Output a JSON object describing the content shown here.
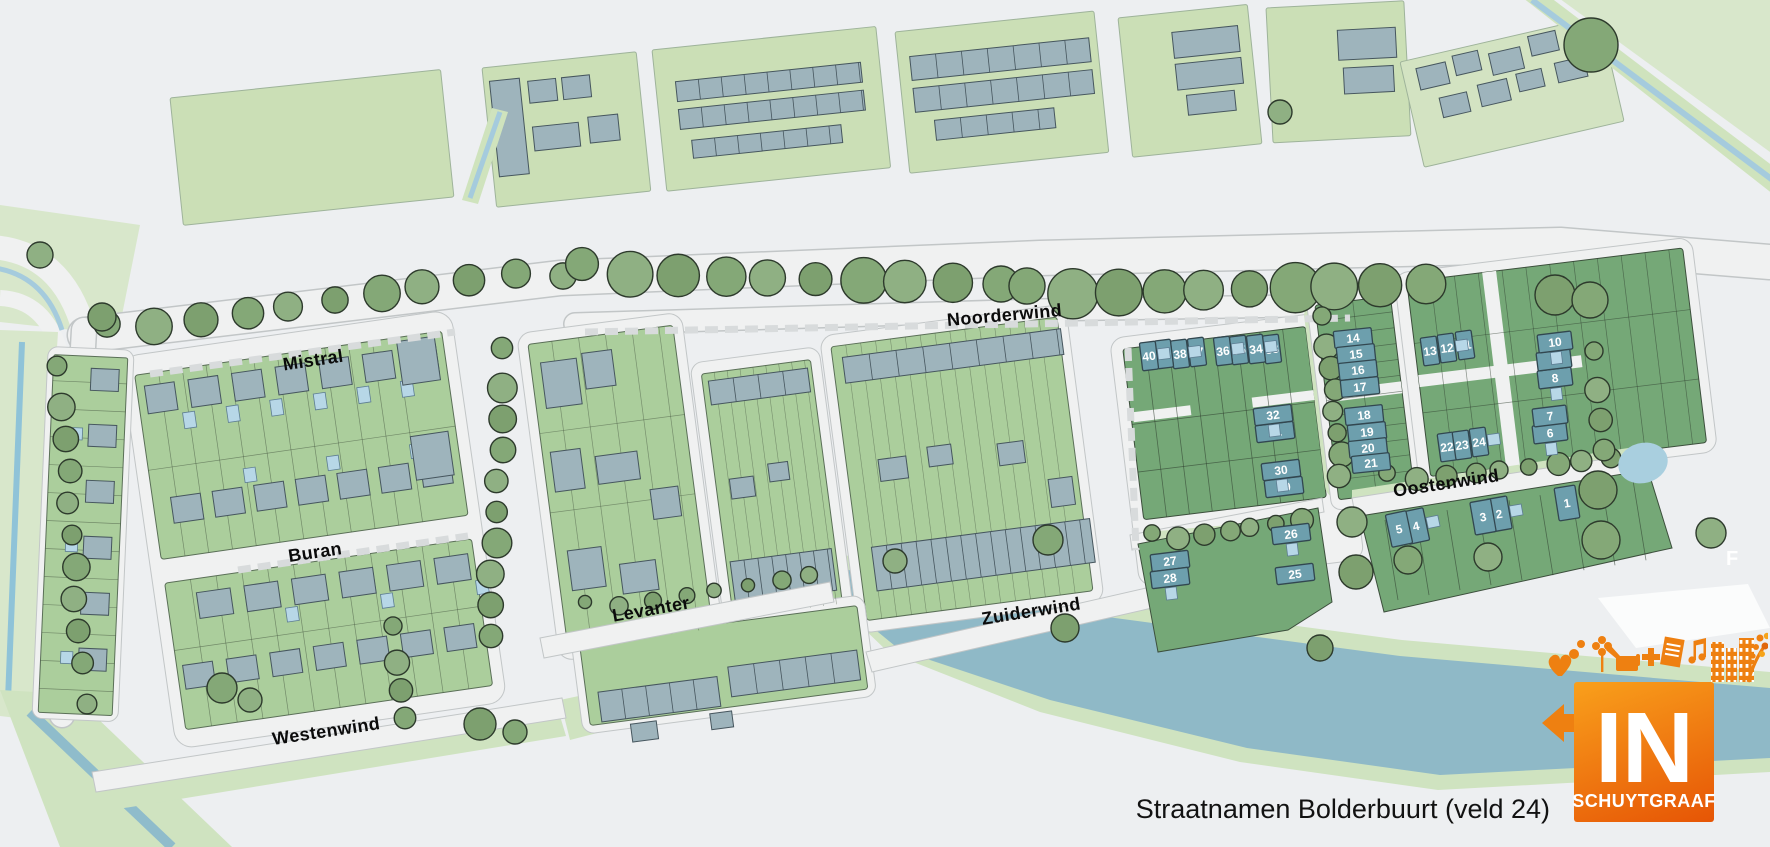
{
  "map": {
    "caption": "Straatnamen Bolderbuurt (veld 24)",
    "edge_label": "F",
    "streets": [
      {
        "name": "Mistral",
        "x": 314,
        "y": 366,
        "angle": -8.5
      },
      {
        "name": "Buran",
        "x": 316,
        "y": 558,
        "angle": -8.5
      },
      {
        "name": "Westenwind",
        "x": 327,
        "y": 737,
        "angle": -8.5
      },
      {
        "name": "Levanter",
        "x": 652,
        "y": 615,
        "angle": -10
      },
      {
        "name": "Noorderwind",
        "x": 1005,
        "y": 321,
        "angle": -5
      },
      {
        "name": "Zuiderwind",
        "x": 1032,
        "y": 617,
        "angle": -9
      },
      {
        "name": "Oostenwind",
        "x": 1447,
        "y": 489,
        "angle": -8.5
      }
    ],
    "lots": [
      {
        "n": 1,
        "x": 1567,
        "y": 503,
        "o": "V",
        "a": -9
      },
      {
        "n": 2,
        "x": 1499,
        "y": 514,
        "o": "V",
        "a": -10
      },
      {
        "n": 3,
        "x": 1483,
        "y": 517,
        "o": "V",
        "a": -10
      },
      {
        "n": 4,
        "x": 1416,
        "y": 526,
        "o": "V",
        "a": -12
      },
      {
        "n": 5,
        "x": 1399,
        "y": 529,
        "o": "V",
        "a": -12
      },
      {
        "n": 6,
        "x": 1550,
        "y": 433,
        "o": "H",
        "a": -7
      },
      {
        "n": 7,
        "x": 1550,
        "y": 416,
        "o": "H",
        "a": -7
      },
      {
        "n": 8,
        "x": 1555,
        "y": 378,
        "o": "H",
        "a": -7
      },
      {
        "n": 9,
        "x": 1554,
        "y": 360,
        "o": "H",
        "a": -7
      },
      {
        "n": 10,
        "x": 1555,
        "y": 342,
        "o": "H",
        "a": -7
      },
      {
        "n": 11,
        "x": 1465,
        "y": 345,
        "o": "v",
        "a": -8
      },
      {
        "n": 12,
        "x": 1447,
        "y": 348,
        "o": "v",
        "a": -8
      },
      {
        "n": 13,
        "x": 1430,
        "y": 351,
        "o": "v",
        "a": -8
      },
      {
        "n": 14,
        "x": 1353,
        "y": 338,
        "o": "h",
        "a": -6
      },
      {
        "n": 15,
        "x": 1356,
        "y": 354,
        "o": "h",
        "a": -6
      },
      {
        "n": 16,
        "x": 1358,
        "y": 370,
        "o": "h",
        "a": -6
      },
      {
        "n": 17,
        "x": 1360,
        "y": 387,
        "o": "h",
        "a": -6
      },
      {
        "n": 18,
        "x": 1364,
        "y": 415,
        "o": "h",
        "a": -6
      },
      {
        "n": 19,
        "x": 1367,
        "y": 432,
        "o": "h",
        "a": -6
      },
      {
        "n": 20,
        "x": 1368,
        "y": 448,
        "o": "h",
        "a": -6
      },
      {
        "n": 21,
        "x": 1371,
        "y": 463,
        "o": "h",
        "a": -6
      },
      {
        "n": 22,
        "x": 1447,
        "y": 447,
        "o": "v",
        "a": -8
      },
      {
        "n": 23,
        "x": 1462,
        "y": 445,
        "o": "v",
        "a": -8
      },
      {
        "n": 24,
        "x": 1479,
        "y": 442,
        "o": "v",
        "a": -8
      },
      {
        "n": 25,
        "x": 1295,
        "y": 574,
        "o": "h",
        "a": -7
      },
      {
        "n": 26,
        "x": 1291,
        "y": 534,
        "o": "h",
        "a": -7
      },
      {
        "n": 27,
        "x": 1170,
        "y": 561,
        "o": "h",
        "a": -7
      },
      {
        "n": 28,
        "x": 1170,
        "y": 578,
        "o": "h",
        "a": -7
      },
      {
        "n": 29,
        "x": 1284,
        "y": 487,
        "o": "h",
        "a": -7
      },
      {
        "n": 30,
        "x": 1281,
        "y": 470,
        "o": "h",
        "a": -7
      },
      {
        "n": 31,
        "x": 1275,
        "y": 432,
        "o": "h",
        "a": -7
      },
      {
        "n": 32,
        "x": 1273,
        "y": 415,
        "o": "h",
        "a": -7
      },
      {
        "n": 33,
        "x": 1272,
        "y": 349,
        "o": "v",
        "a": -7
      },
      {
        "n": 34,
        "x": 1256,
        "y": 349,
        "o": "v",
        "a": -7
      },
      {
        "n": 35,
        "x": 1239,
        "y": 350,
        "o": "v",
        "a": -7
      },
      {
        "n": 36,
        "x": 1223,
        "y": 351,
        "o": "v",
        "a": -7
      },
      {
        "n": 37,
        "x": 1197,
        "y": 352,
        "o": "v",
        "a": -7
      },
      {
        "n": 38,
        "x": 1180,
        "y": 354,
        "o": "v",
        "a": -7
      },
      {
        "n": 39,
        "x": 1164,
        "y": 354,
        "o": "v",
        "a": -7
      },
      {
        "n": 40,
        "x": 1149,
        "y": 356,
        "o": "v",
        "a": -7
      }
    ]
  },
  "logo": {
    "word": "IN",
    "subtitle": "SCHUYTGRAAF"
  },
  "colors": {
    "background": "#edeff1",
    "road": "#f0f1f1",
    "road_casing": "#c2c6c7",
    "field_green": "#cbdfb6",
    "lot_green_light": "#abce9c",
    "lot_green_dark": "#75a877",
    "shore_green": "#cfe3c0",
    "pale_green": "#d8e7cb",
    "tree_green": "#84a877",
    "water": "#8fb9c7",
    "canal_blue": "#a5cbdd",
    "pond_blue": "#a9cfdf",
    "building_gray": "#9eb4bc",
    "shed_blue": "#b7d7e7",
    "numbered_lot": "#6d9fad",
    "logo_orange_light": "#f9a01b",
    "logo_orange_dark": "#e65505"
  }
}
